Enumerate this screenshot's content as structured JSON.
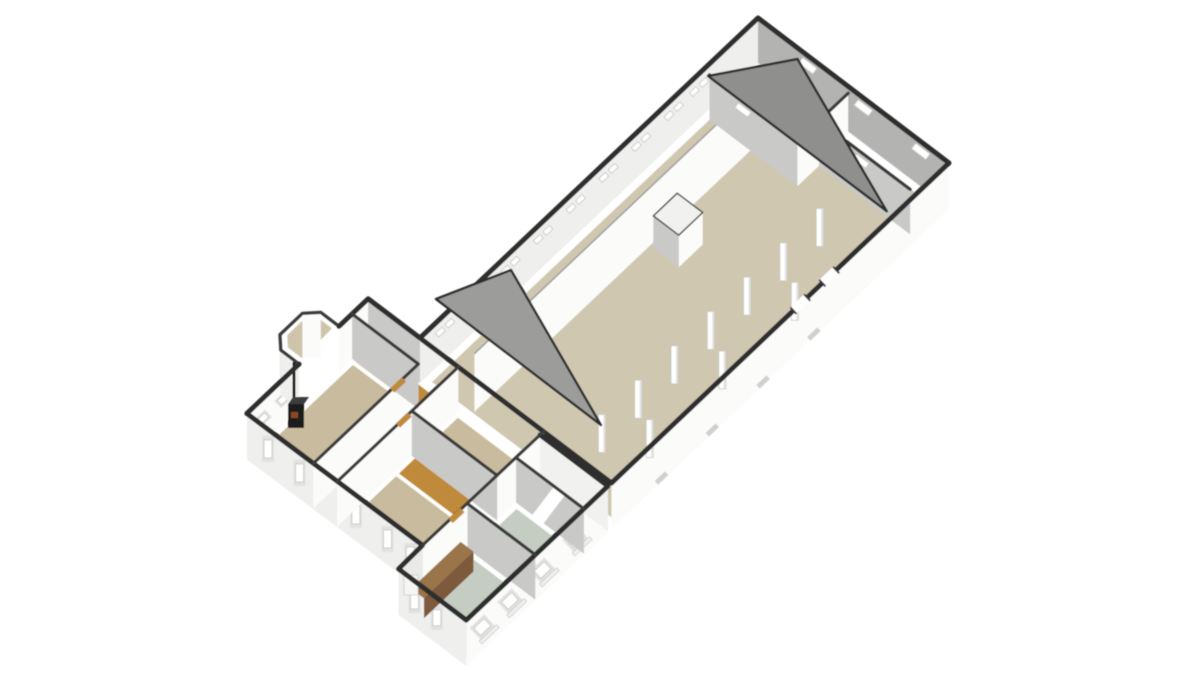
{
  "meta": {
    "title": "3D floor plan",
    "description": "Isometric 3D render of an elongated hall building with an attached residence, entry porch and utility extension on a white background"
  },
  "colors": {
    "background": "#ffffff",
    "outline": "#2e2e2e",
    "outline_inner": "#3a3a3a",
    "floor_main": "#cfc7b0",
    "floor_tan": "#c8bb9e",
    "floor_wood": "#c08a3e",
    "floor_green": "#c5ccc1",
    "floor_porch": "#cdc4aa",
    "wall_white": "#fbfbfa",
    "wall_light": "#efefed",
    "wall_mid": "#c9c9c7",
    "wall_dark": "#b3b3b1",
    "wall_top_edge": "#9b9b9b",
    "gable_gray": "#9c9c9a",
    "gable_dark": "#8f8f8d",
    "window_frame": "#e2e2e0",
    "window_glass": "#ffffff",
    "vent": "#d0d0ce",
    "counter_top": "#9a7448",
    "counter_front": "#7b5a3a",
    "appliance": "#f6f6f5",
    "stove_body": "#1f1f1f",
    "stove_top": "#3c3c3c",
    "stove_glow": "#8a4a20",
    "pillar": "#ffffff",
    "pillar_shade": "#e0e0de"
  },
  "scene": {
    "pillar_count": 10,
    "hall_window_slit_pairs": 9,
    "end_wall_windows": 3,
    "extension_se_windows": 4,
    "extension_sw_windows": 2,
    "house_sw_windows": 5,
    "objects": [
      "main-hall",
      "hall-corridor",
      "interior-long-wall",
      "feed-stall-box",
      "support-pillars",
      "end-rooms",
      "gable-walls",
      "living-room-with-wood-stove",
      "wood-floor-hallways",
      "bedrooms",
      "entry-porch",
      "utility-extension",
      "kitchen-counter"
    ]
  }
}
